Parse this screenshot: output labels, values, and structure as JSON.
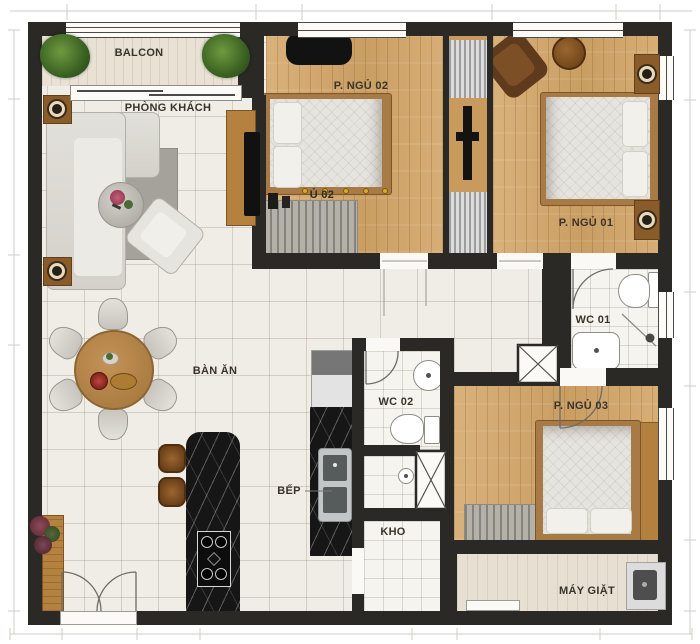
{
  "rooms": {
    "balcony": {
      "label": "BALCON"
    },
    "living": {
      "label": "PHÒNG KHÁCH"
    },
    "bedroom2": {
      "label": "P. NGỦ 02",
      "ghost_label": "Ủ 02"
    },
    "bedroom1": {
      "label": "P. NGỦ 01"
    },
    "wc1": {
      "label": "WC 01"
    },
    "dining": {
      "label": "BÀN ĂN"
    },
    "wc2": {
      "label": "WC 02"
    },
    "bedroom3": {
      "label": "P. NGỦ 03"
    },
    "kitchen": {
      "label": "BẾP"
    },
    "storage": {
      "label": "KHO"
    },
    "laundry": {
      "label": "MÁY GIẶT"
    }
  },
  "colors": {
    "wall": "#2b2926",
    "tile_floor": "#f0ede6",
    "wood_floor": "#d4aa72",
    "marble_counter": "#161616",
    "bed_frame": "#a87a45",
    "label_text": "#3a332b"
  }
}
